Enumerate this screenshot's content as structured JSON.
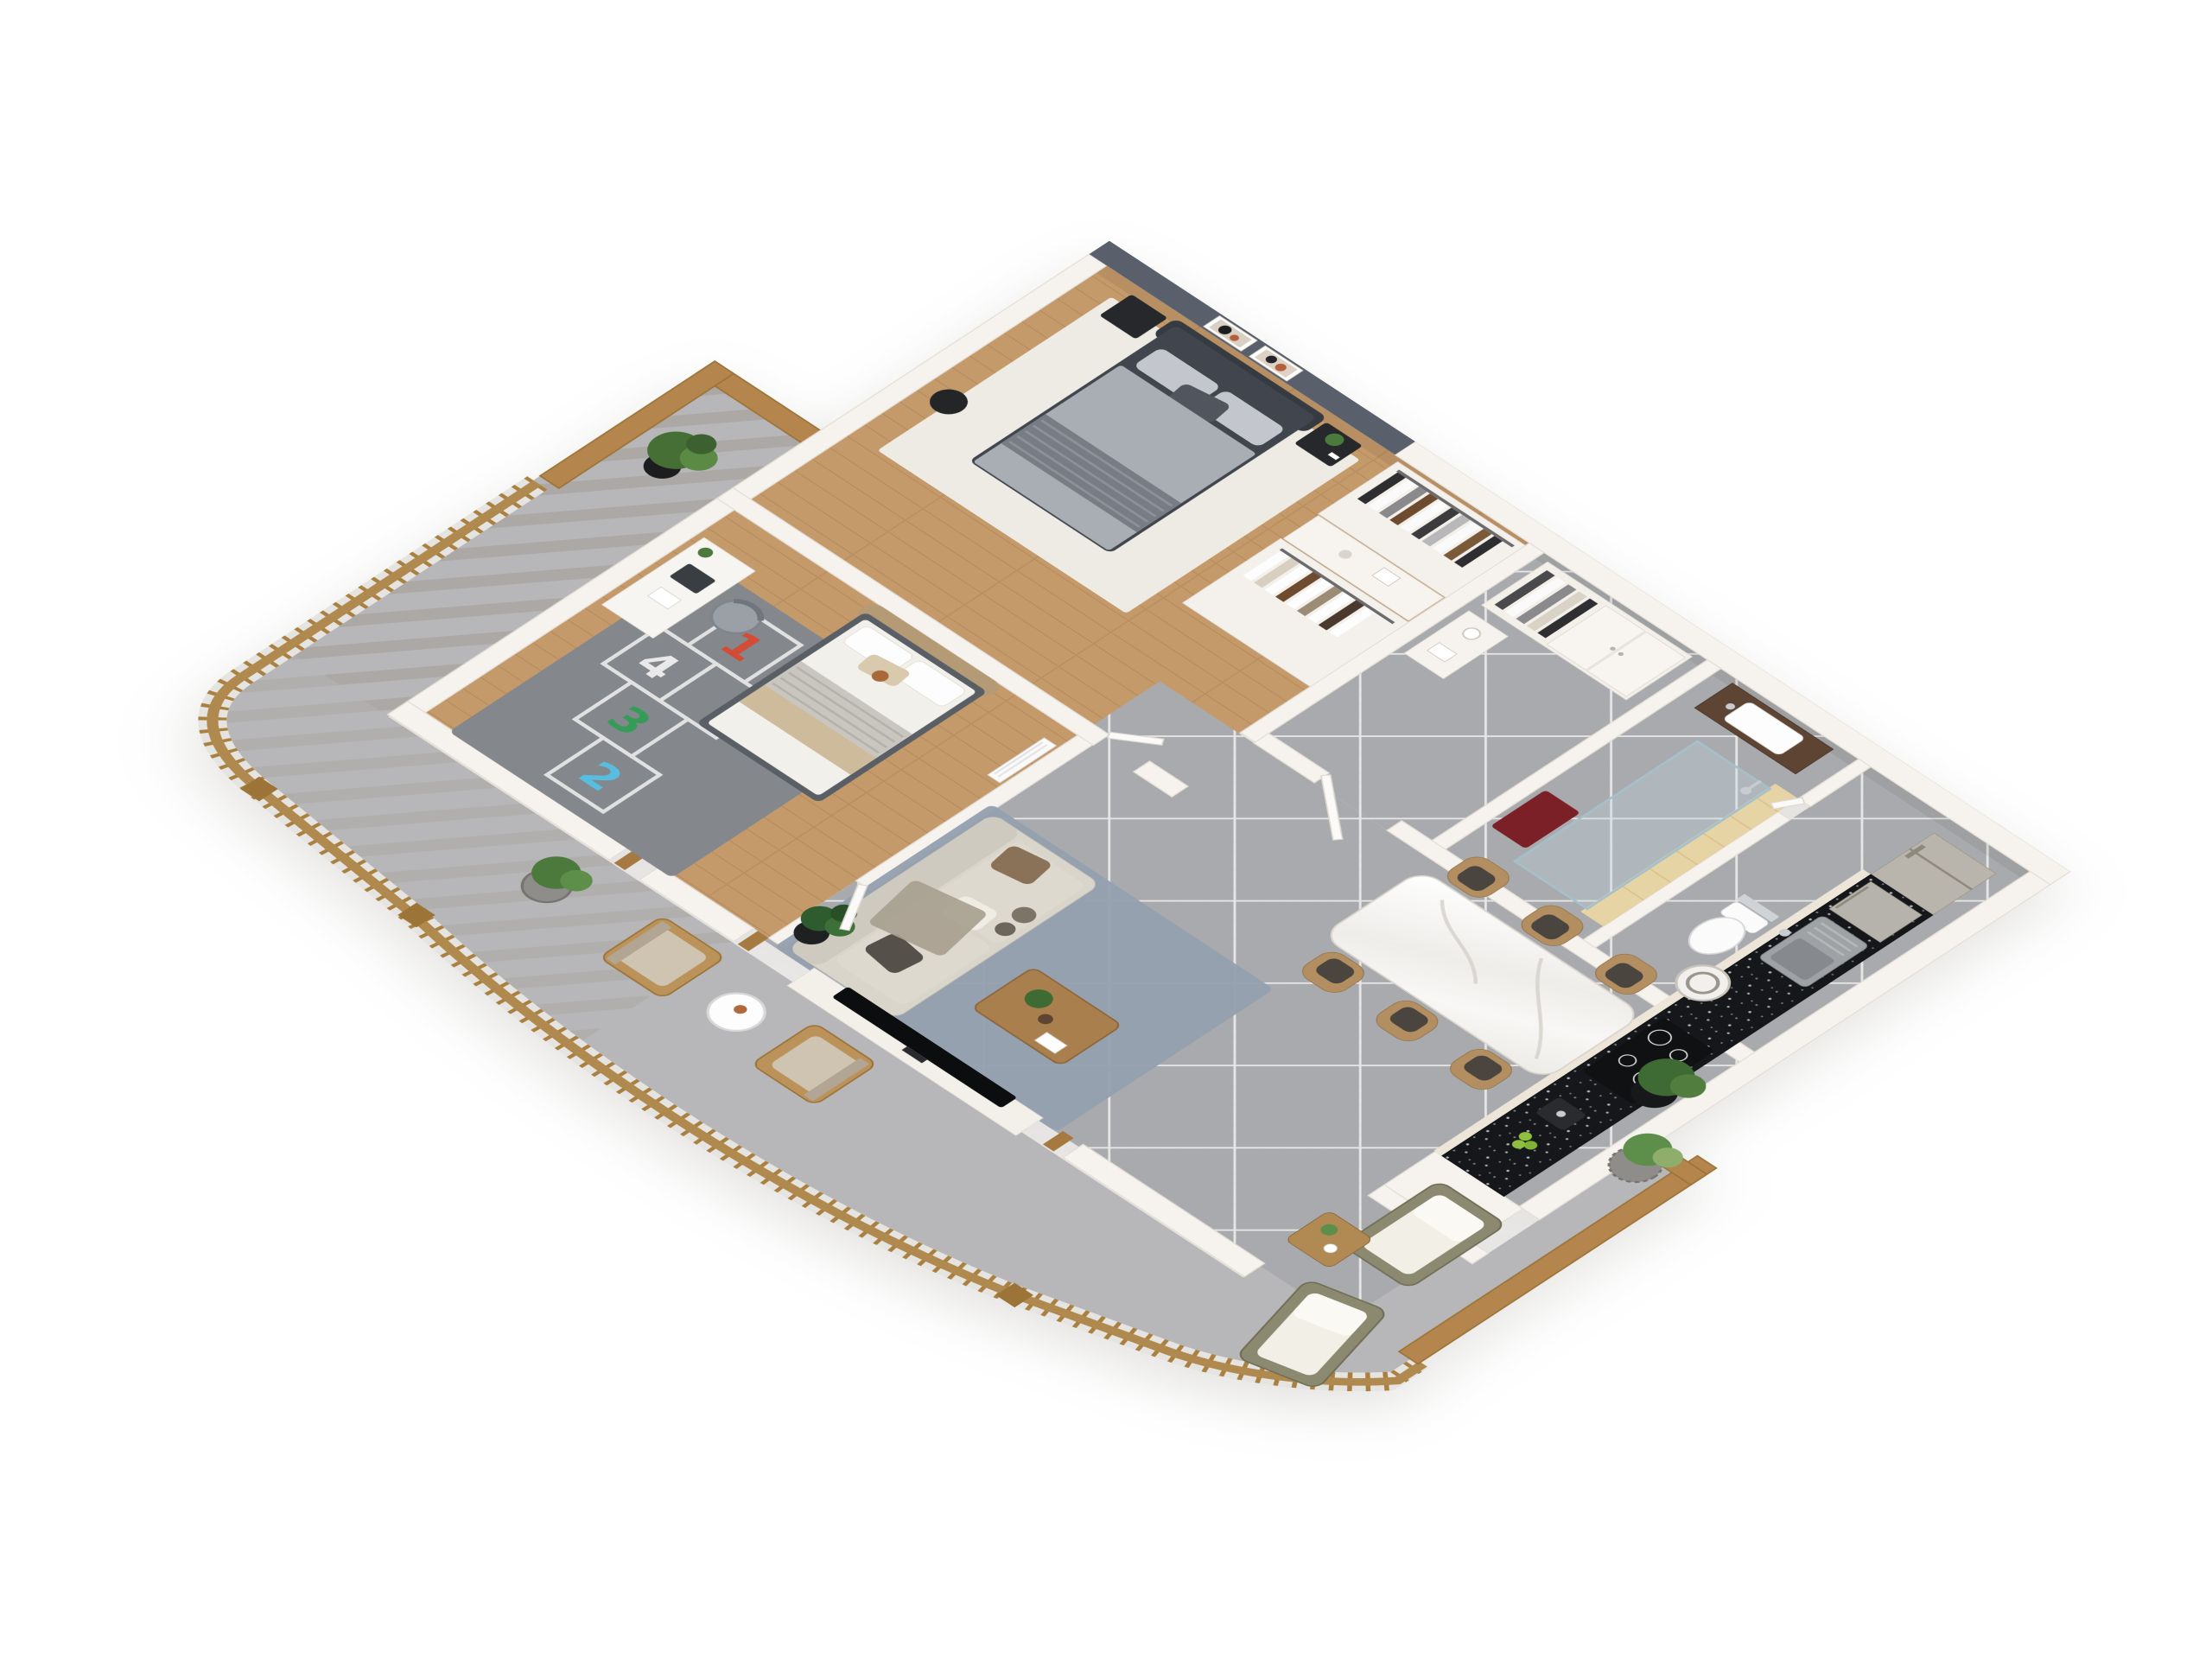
{
  "scene": {
    "type": "isometric-3d-floor-plan-render",
    "view": "axonometric top-down",
    "background": "#ffffff"
  },
  "palette": {
    "wall_white": "#f6f3ee",
    "accent_wall_gray": "#5a606b",
    "wood_floor": "#c59a6b",
    "tile_floor_gray": "#a9aaad",
    "balcony_concrete": "#b7b6b8",
    "railing_wood": "#b0894e",
    "privacy_fence_wood": "#b5854e",
    "kitchen_counter_black": "#16171a",
    "cabinet_cream": "#ece5d8",
    "fridge_steel": "#b9b5ac",
    "sofa_cream": "#d9d5cb",
    "master_bed_gray": "#41464e",
    "kids_bed_white": "#f2f0ea",
    "rug_white": "#efede8",
    "rug_living_blue": "#95a0af",
    "rug_hopscotch_gray": "#84878c",
    "dining_marble": "#f4f2ef",
    "dining_chair_tan": "#b28e60",
    "shower_tile_beige": "#e7d4a5",
    "bath_mat_red": "#7c2028",
    "plant_green": "#4c7a3d",
    "coffee_table_wood": "#aa7f4e"
  },
  "hopscotch_rug": {
    "numbers": [
      {
        "value": "1",
        "color": "#d9472f"
      },
      {
        "value": "4",
        "color": "#f2f2f2"
      },
      {
        "value": "3",
        "color": "#2f9e53"
      },
      {
        "value": "2",
        "color": "#54c3ea"
      }
    ]
  },
  "inventory": {
    "areas": [
      "master-bedroom",
      "walk-in-closet",
      "entry-hall",
      "bathroom",
      "wc",
      "kids-bedroom",
      "open-kitchen-living-dining",
      "west-balcony",
      "south-balcony",
      "east-terrace"
    ],
    "key_furniture": [
      "double-bed",
      "nightstands",
      "wall-art",
      "wardrobe-clothes-racks",
      "vanity-sink",
      "glass-shower",
      "wall-hung-toilet",
      "fridge",
      "kitchen-sink",
      "washing-machine",
      "cooktop",
      "coffee-machine",
      "marble-dining-table",
      "six-dining-chairs",
      "cream-sofa",
      "coffee-table",
      "tv",
      "single-bed",
      "desk-with-laptop",
      "outdoor-armchairs",
      "outdoor-lounge-chairs",
      "potted-plants"
    ],
    "dining_chair_count": 6
  }
}
